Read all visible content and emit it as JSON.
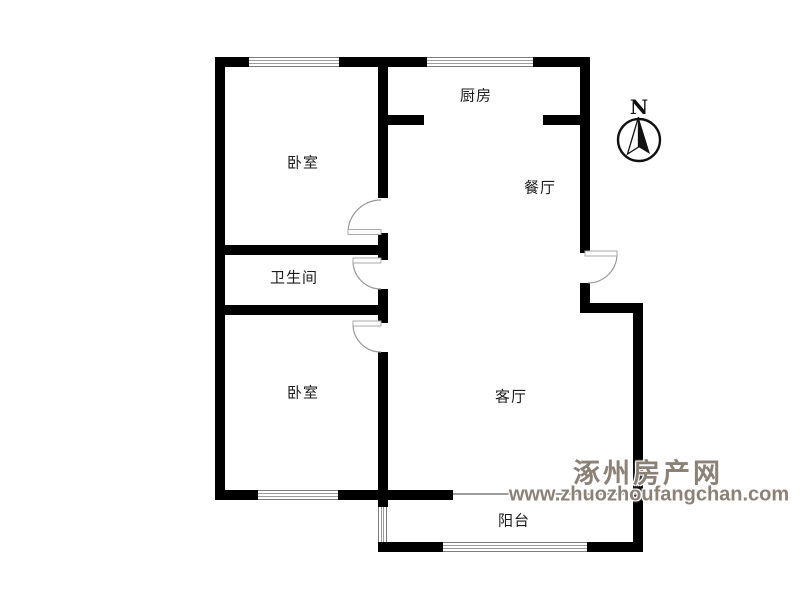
{
  "title": "apartment-floor-plan",
  "rooms": [
    {
      "id": "bedroom-1",
      "label": "卧室"
    },
    {
      "id": "kitchen",
      "label": "厨房"
    },
    {
      "id": "dining",
      "label": "餐厅"
    },
    {
      "id": "bathroom",
      "label": "卫生间"
    },
    {
      "id": "bedroom-2",
      "label": "卧室"
    },
    {
      "id": "living",
      "label": "客厅"
    },
    {
      "id": "balcony",
      "label": "阳台"
    }
  ],
  "compass": {
    "north_label": "N"
  },
  "watermark": {
    "site_name": "涿州房产网",
    "url": "www.zhuozhoufangchan.com",
    "color": "#8b8177"
  },
  "colors": {
    "wall": "#000000",
    "window_line": "#9c9c9c",
    "door_arc": "#999999",
    "background": "#ffffff"
  },
  "features": {
    "doors": [
      "bedroom-1-door",
      "bathroom-door",
      "bedroom-2-door",
      "entry-door"
    ],
    "windows": [
      "bedroom-1-window-top",
      "kitchen-window-top",
      "bedroom-2-window-bottom",
      "balcony-window-left",
      "balcony-window-bottom"
    ]
  }
}
